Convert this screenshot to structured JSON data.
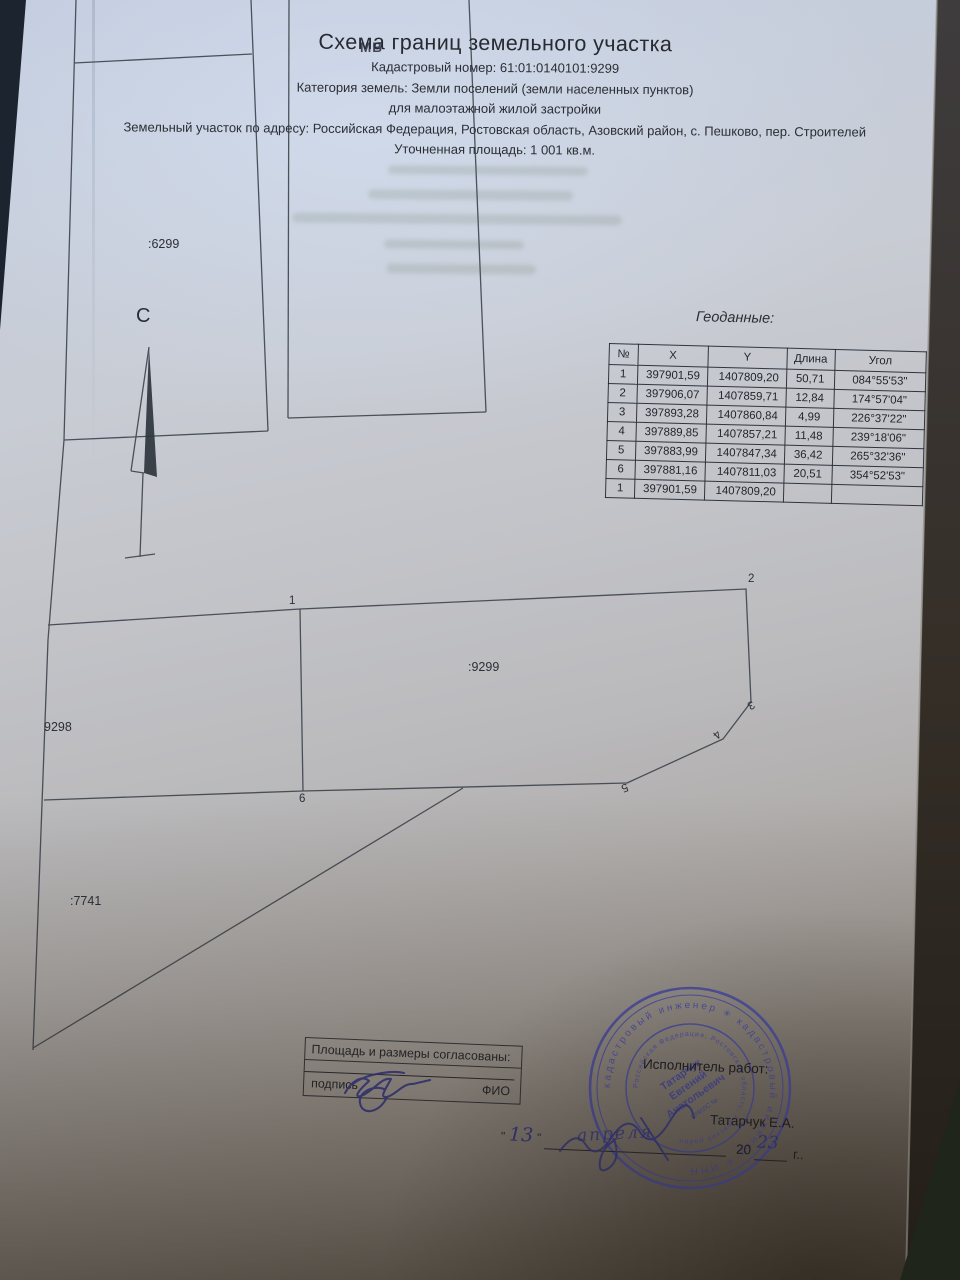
{
  "header": {
    "title": "Схема границ земельного участка",
    "ghost": "МВ",
    "lines": [
      "Кадастровый номер: 61:01:0140101:9299",
      "Категория земель: Земли поселений (земли населенных пунктов)",
      "для малоэтажной жилой застройки",
      "Земельный участок по адресу: Российская Федерация, Ростовская область, Азовский район, с. Пешково, пер. Строителей",
      "Уточненная площадь: 1 001 кв.м."
    ]
  },
  "geodata": {
    "title": "Геоданные:",
    "columns": [
      "№",
      "X",
      "Y",
      "Длина",
      "Угол"
    ],
    "rows": [
      [
        "1",
        "397901,59",
        "1407809,20",
        "50,71",
        "084°55'53\""
      ],
      [
        "2",
        "397906,07",
        "1407859,71",
        "12,84",
        "174°57'04\""
      ],
      [
        "3",
        "397893,28",
        "1407860,84",
        "4,99",
        "226°37'22\""
      ],
      [
        "4",
        "397889,85",
        "1407857,21",
        "11,48",
        "239°18'06\""
      ],
      [
        "5",
        "397883,99",
        "1407847,34",
        "36,42",
        "265°32'36\""
      ],
      [
        "6",
        "397881,16",
        "1407811,03",
        "20,51",
        "354°52'53\""
      ],
      [
        "1",
        "397901,59",
        "1407809,20",
        "",
        ""
      ]
    ]
  },
  "plan": {
    "north_label": "С",
    "parcel_top_left": ":6299",
    "parcel_main": ":9299",
    "parcel_left": "9298",
    "parcel_bottom": ":7741",
    "points": [
      "1",
      "2",
      "3",
      "4",
      "5",
      "6"
    ]
  },
  "approval": {
    "title": "Площадь и размеры согласованы:",
    "sign_label": "подпись",
    "name_label": "ФИО"
  },
  "executor": {
    "label": "Исполнитель работ:",
    "name": "Татарчук Е.А.",
    "quote": "\"",
    "day": "13",
    "month": "апреля",
    "year_prefix": "20",
    "year_value": "23",
    "year_suffix": "г.."
  },
  "stamp": {
    "outer_text": "кадастровый инженер  ✳  кадастровый инженер  ✳  ИНН",
    "middle_text": "Российская Федерация, Ростовская область, Азовский район",
    "center_line1": "Татарчук",
    "center_line2": "Евгений",
    "center_line3": "Анатольевич",
    "snils": "СНИЛС №"
  }
}
